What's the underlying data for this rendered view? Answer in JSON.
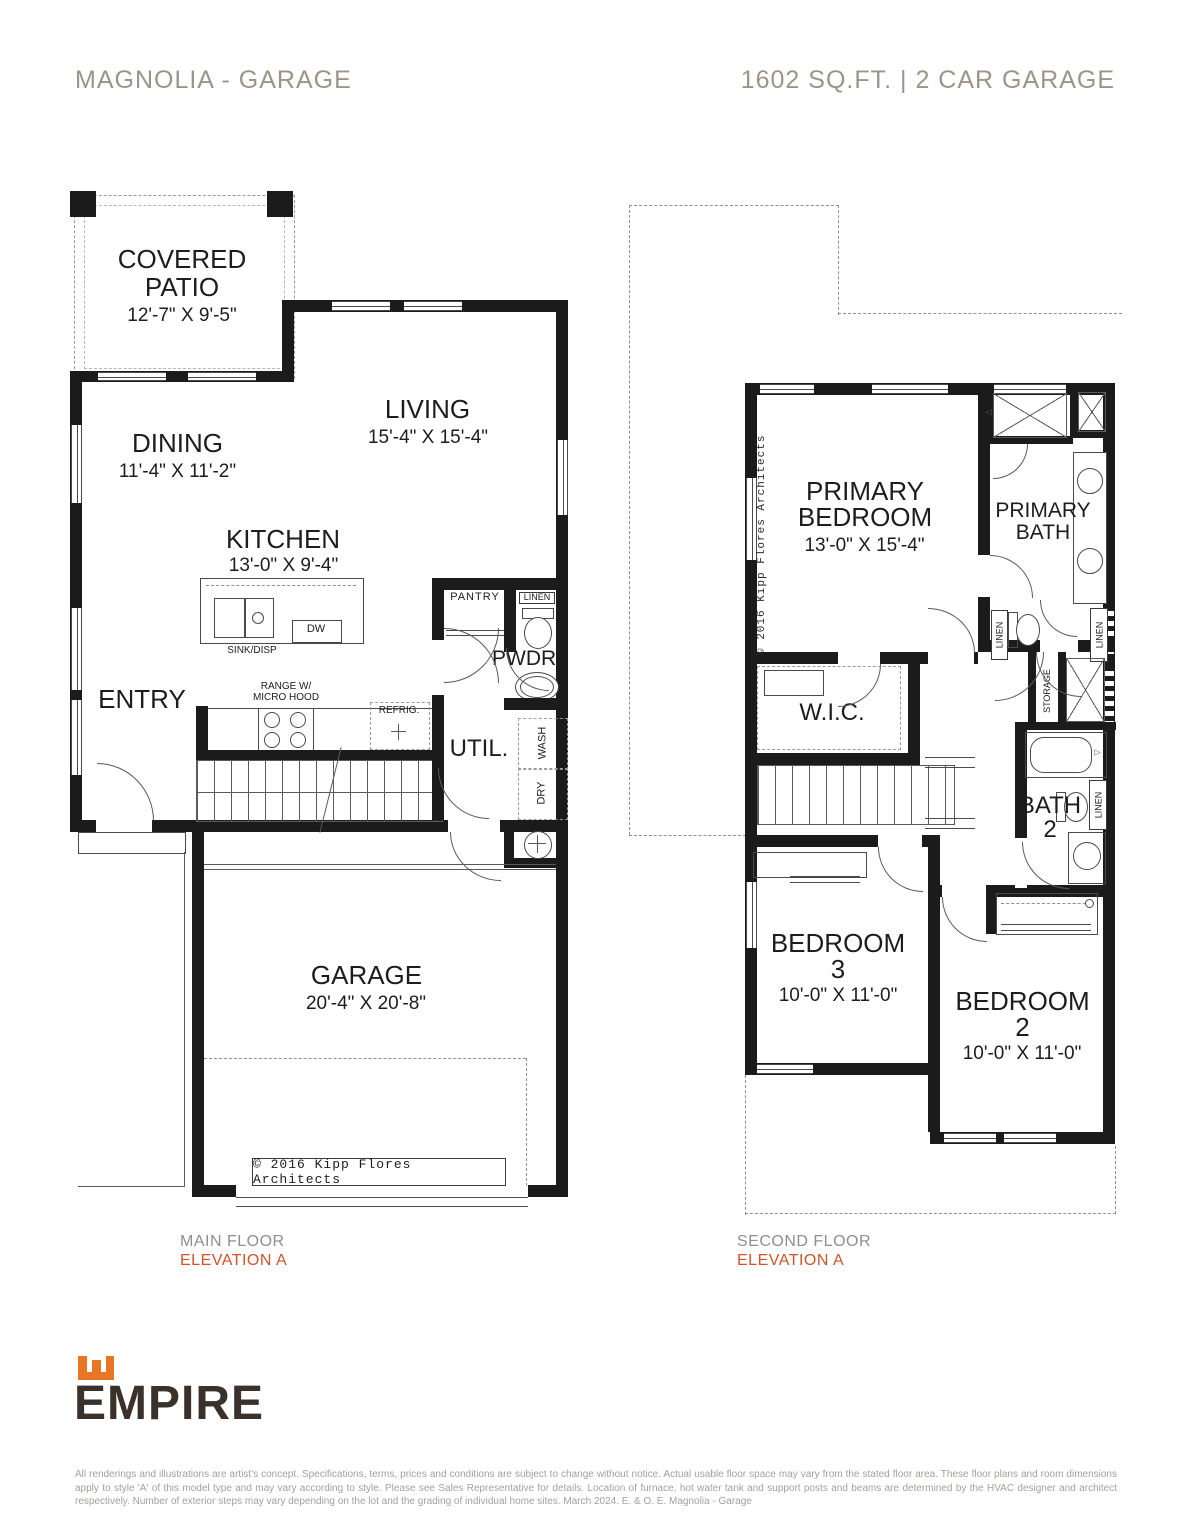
{
  "header": {
    "title": "MAGNOLIA - GARAGE",
    "specs": "1602 SQ.FT. | 2 CAR GARAGE"
  },
  "main_floor": {
    "caption": {
      "floor": "MAIN FLOOR",
      "elevation": "ELEVATION A"
    },
    "rooms": {
      "covered_patio": {
        "line1": "COVERED",
        "line2": "PATIO",
        "dims": "12'-7\" X 9'-5\""
      },
      "dining": {
        "name": "DINING",
        "dims": "11'-4\" X 11'-2\""
      },
      "living": {
        "name": "LIVING",
        "dims": "15'-4\" X 15'-4\""
      },
      "kitchen": {
        "name": "KITCHEN",
        "dims": "13'-0\" X 9'-4\""
      },
      "entry": {
        "name": "ENTRY"
      },
      "pantry": {
        "name": "PANTRY"
      },
      "linen": {
        "name": "LINEN"
      },
      "powder": {
        "name": "PWDR."
      },
      "utility": {
        "name": "UTIL."
      },
      "garage": {
        "name": "GARAGE",
        "dims": "20'-4\" X 20'-8\""
      }
    },
    "fixtures": {
      "sink": "SINK/DISP",
      "dishwasher": "DW",
      "range_line1": "RANGE W/",
      "range_line2": "MICRO HOOD",
      "fridge": "REFRIG.",
      "washer": "WASH",
      "dryer": "DRY"
    },
    "copyright": "© 2016 Kipp Flores Architects"
  },
  "second_floor": {
    "caption": {
      "floor": "SECOND FLOOR",
      "elevation": "ELEVATION A"
    },
    "rooms": {
      "primary_bedroom": {
        "line1": "PRIMARY",
        "line2": "BEDROOM",
        "dims": "13'-0\" X 15'-4\""
      },
      "primary_bath": {
        "line1": "PRIMARY",
        "line2": "BATH"
      },
      "wic": {
        "name": "W.I.C."
      },
      "bath2": {
        "line1": "BATH",
        "line2": "2"
      },
      "bedroom3": {
        "line1": "BEDROOM",
        "line2": "3",
        "dims": "10'-0\" X 11'-0\""
      },
      "bedroom2": {
        "line1": "BEDROOM",
        "line2": "2",
        "dims": "10'-0\" X 11'-0\""
      }
    },
    "closets": {
      "storage": "STORAGE",
      "linen_hall": "LINEN",
      "linen_bath": "LINEN",
      "linen_bath2": "LINEN"
    },
    "copyright": "© 2016 Kipp Flores Architects"
  },
  "icons": {
    "faucet": "▽"
  },
  "colors": {
    "wall": "#1b1b1b",
    "header_text": "#9c9489",
    "elevation_accent": "#d1532a",
    "brand_orange": "#e87725",
    "brand_text": "#39312a"
  },
  "footer": {
    "brand": "EMPIRE",
    "disclaimer": "All renderings and illustrations are artist's concept. Specifications, terms, prices and conditions are subject to change without notice. Actual usable floor space may vary from the stated floor area. These floor plans and room dimensions apply to style 'A' of this model type and may vary according to style. Please see Sales Representative for details. Location of furnace, hot water tank and support posts and beams are determined by the HVAC designer and architect respectively. Number of exterior steps may vary depending on the lot and the grading of individual home sites. March 2024. E. & O. E. Magnolia - Garage"
  }
}
